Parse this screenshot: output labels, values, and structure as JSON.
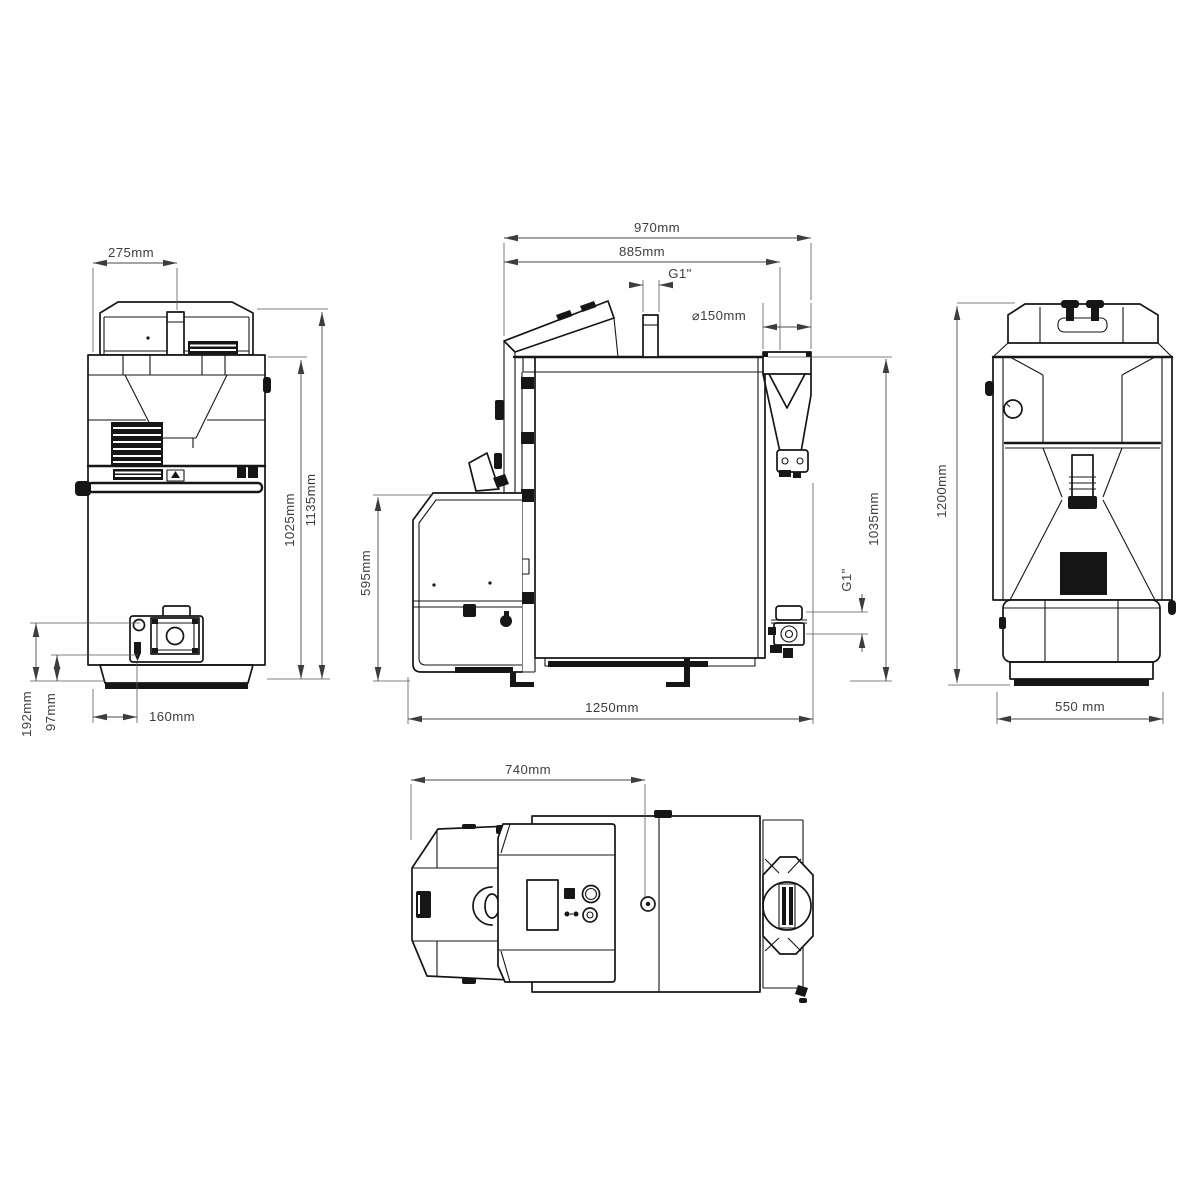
{
  "drawing": {
    "type": "technical-drawing",
    "subject": "pellet boiler - four orthographic views with dimensions",
    "views": {
      "front": {
        "label": "front-view",
        "dims": {
          "top_offset": "275mm",
          "body_height": "1025mm",
          "total_height": "1135mm",
          "connector_height": "192mm",
          "lever_height": "97mm",
          "burner_offset": "160mm"
        }
      },
      "side": {
        "label": "side-view",
        "dims": {
          "depth_overall_top": "970mm",
          "depth_lid": "885mm",
          "flow_connection": "G1\"",
          "flue_diameter": "⌀150mm",
          "burner_height": "595mm",
          "connection_height": "1035mm",
          "depth_total": "1250mm",
          "return_connection": "G1\""
        }
      },
      "back": {
        "label": "back-view",
        "dims": {
          "total_height": "1200mm",
          "width": "550 mm"
        }
      },
      "top": {
        "label": "top-view",
        "dims": {
          "front_depth": "740mm"
        }
      }
    },
    "colors": {
      "line": "#161616",
      "dimension": "#4a4a4a",
      "background": "#ffffff"
    }
  }
}
